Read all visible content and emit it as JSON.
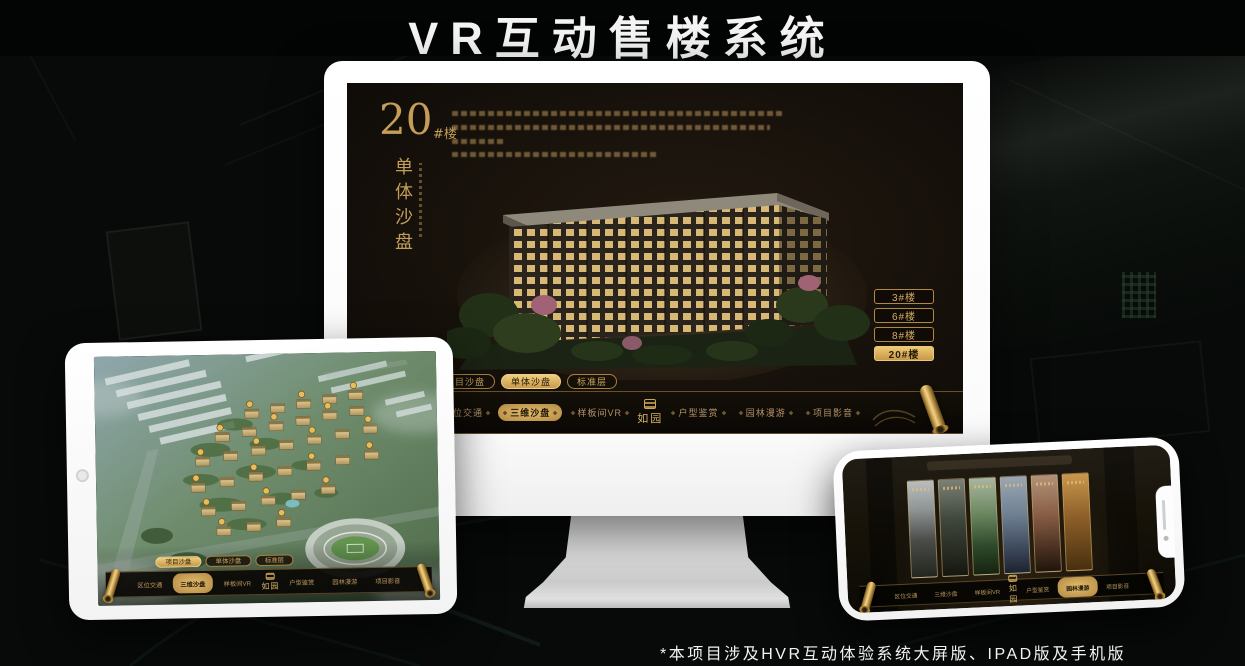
{
  "page": {
    "title": "VR互动售楼系统",
    "footnote": "*本项目涉及HVR互动体验系统大屏版、IPAD版及手机版"
  },
  "colors": {
    "accent_gold": "#c9a25c",
    "accent_gold_bright": "#eec973",
    "screen_background": "#17110b"
  },
  "monitor": {
    "headline": {
      "number": "20",
      "suffix": "#楼",
      "subtitle": "单体沙盘"
    },
    "floor_buttons": [
      {
        "label": "3#楼",
        "active": false
      },
      {
        "label": "6#楼",
        "active": false
      },
      {
        "label": "8#楼",
        "active": false
      },
      {
        "label": "20#楼",
        "active": true
      }
    ],
    "tabs": [
      {
        "label": "项目沙盘",
        "active": false
      },
      {
        "label": "单体沙盘",
        "active": true
      },
      {
        "label": "标准层",
        "active": false
      }
    ],
    "nav_items": [
      {
        "label": "区位交通",
        "active": false
      },
      {
        "label": "三维沙盘",
        "active": true
      },
      {
        "label": "样板间VR",
        "active": false
      },
      {
        "label": "户型鉴赏",
        "active": false
      },
      {
        "label": "园林漫游",
        "active": false
      },
      {
        "label": "项目影音",
        "active": false
      }
    ],
    "logo_text": "如园"
  },
  "ipad": {
    "tabs": [
      {
        "label": "项目沙盘",
        "active": true
      },
      {
        "label": "单体沙盘",
        "active": false
      },
      {
        "label": "标准层",
        "active": false
      }
    ],
    "nav_items": [
      {
        "label": "区位交通",
        "active": false
      },
      {
        "label": "三维沙盘",
        "active": true
      },
      {
        "label": "样板间VR",
        "active": false
      },
      {
        "label": "户型鉴赏",
        "active": false
      },
      {
        "label": "园林漫游",
        "active": false
      },
      {
        "label": "项目影音",
        "active": false
      }
    ],
    "logo_text": "如园"
  },
  "phone": {
    "nav_items": [
      {
        "label": "区位交通",
        "active": false
      },
      {
        "label": "三维沙盘",
        "active": false
      },
      {
        "label": "样板间VR",
        "active": false
      },
      {
        "label": "户型鉴赏",
        "active": false
      },
      {
        "label": "园林漫游",
        "active": true
      },
      {
        "label": "项目影音",
        "active": false
      }
    ],
    "logo_text": "如园"
  }
}
